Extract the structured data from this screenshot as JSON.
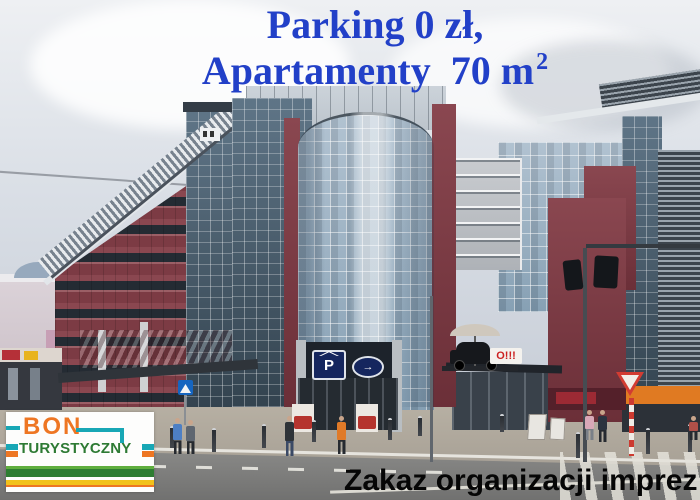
{
  "headline": {
    "line1": "Parking 0 zł,",
    "line2": "Apartamenty  70 m",
    "line2_superscript": "2",
    "color": "#2240c8"
  },
  "bottom_notice": {
    "text": "Zakaz organizacji imprez",
    "color": "#060606"
  },
  "logo": {
    "title": "BON",
    "subtitle": "TURYSTYCZNY",
    "colors": {
      "title": "#ee7623",
      "subtitle": "#2d7a33",
      "bracket": "#18a7b5",
      "stripe_teal": "#18a7b5",
      "stripe_orange": "#ee7623",
      "stripe_green_light": "#5fae3e",
      "stripe_green_dark": "#2e7d32",
      "stripe_yellow": "#f2c21c"
    }
  },
  "street_signs": {
    "parking_letter": "P",
    "parking_arrow": "→",
    "parking_sign_color": "#15265e",
    "storefront_sign": "O!!!",
    "storefront_sign_color": "#cc2222"
  }
}
